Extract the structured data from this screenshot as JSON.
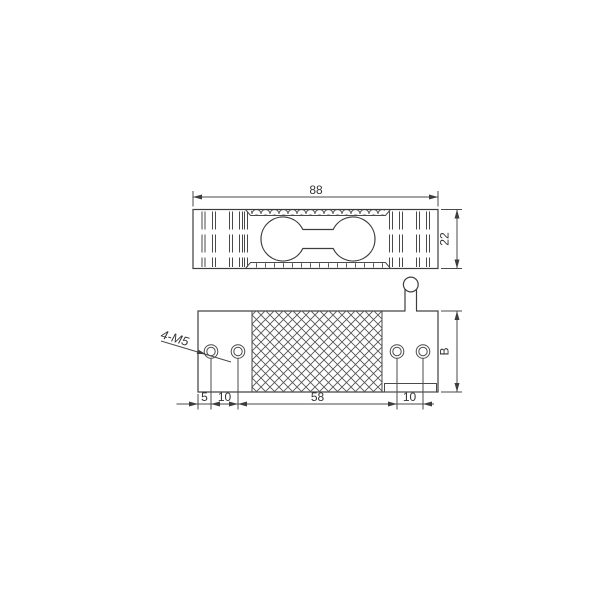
{
  "colors": {
    "background": "#ffffff",
    "line": "#3d3d3d",
    "text": "#333333"
  },
  "views": {
    "side_view": {
      "dim_width": "88",
      "dim_height": "22"
    },
    "plan_view": {
      "thread_label": "4-M5",
      "dim_edge_to_hole": "5",
      "dim_hole_pitch_left": "10",
      "dim_hole_span": "58",
      "dim_hole_pitch_right": "10",
      "dim_depth": "B"
    }
  }
}
